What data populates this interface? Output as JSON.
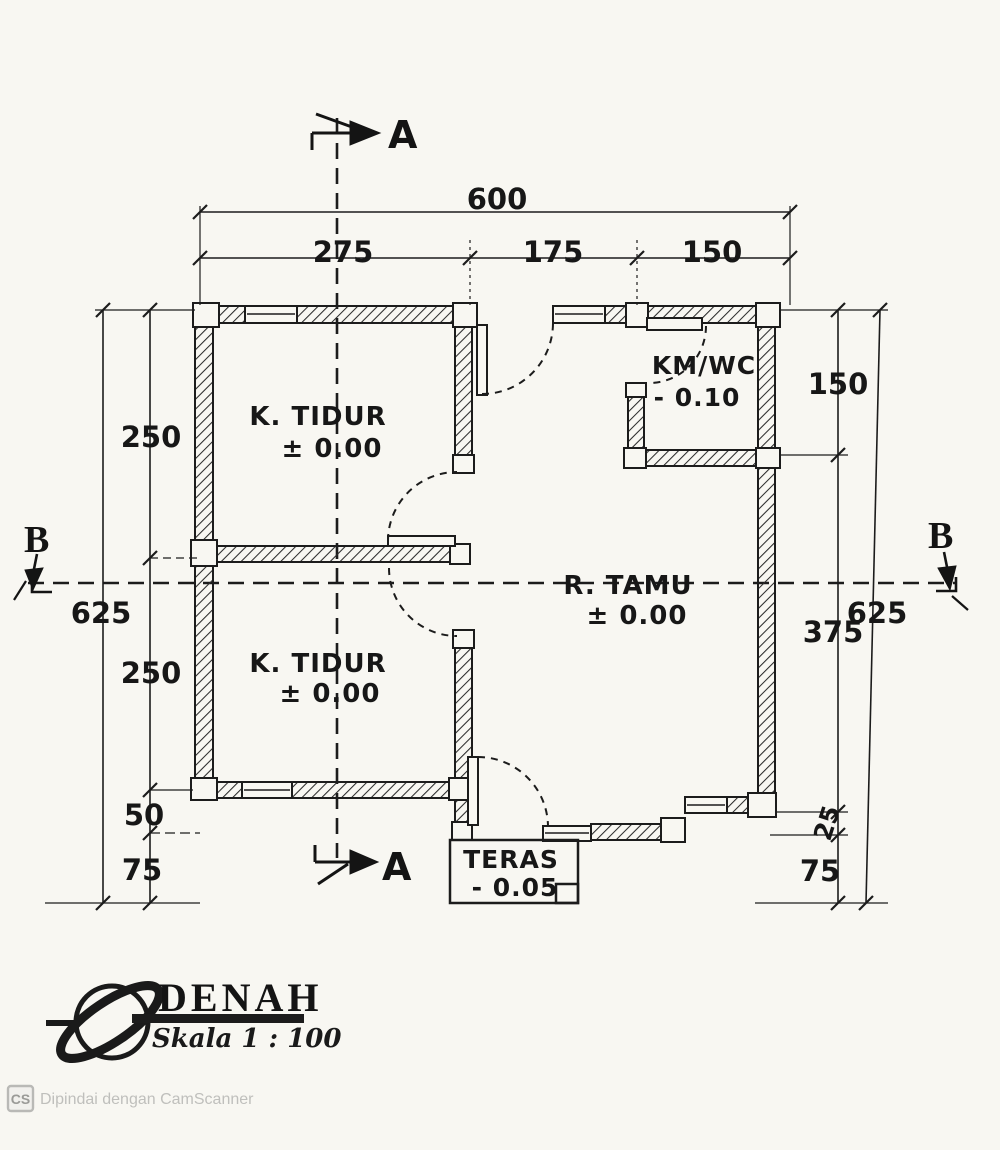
{
  "title_block": {
    "title": "DENAH",
    "scale": "Skala 1 : 100"
  },
  "footer": {
    "badge": "CS",
    "text": "Dipindai dengan CamScanner"
  },
  "sections": {
    "a_top": "A",
    "a_bottom": "A",
    "b_left": "B",
    "b_right": "B"
  },
  "rooms": {
    "bedroom_top": {
      "name": "K. TIDUR",
      "level": "± 0.00"
    },
    "bedroom_bottom": {
      "name": "K. TIDUR",
      "level": "± 0.00"
    },
    "bathroom": {
      "name": "KM/WC",
      "level": "- 0.10"
    },
    "living": {
      "name": "R. TAMU",
      "level": "± 0.00"
    },
    "terrace": {
      "name": "TERAS",
      "level": "- 0.05"
    }
  },
  "dims": {
    "top_total": "600",
    "top_a": "275",
    "top_b": "175",
    "top_c": "150",
    "left_total": "625",
    "left_a": "250",
    "left_b": "250",
    "left_c": "50",
    "left_d": "75",
    "right_total": "625",
    "right_a": "150",
    "right_b": "375",
    "right_c": "25",
    "right_d": "75"
  }
}
